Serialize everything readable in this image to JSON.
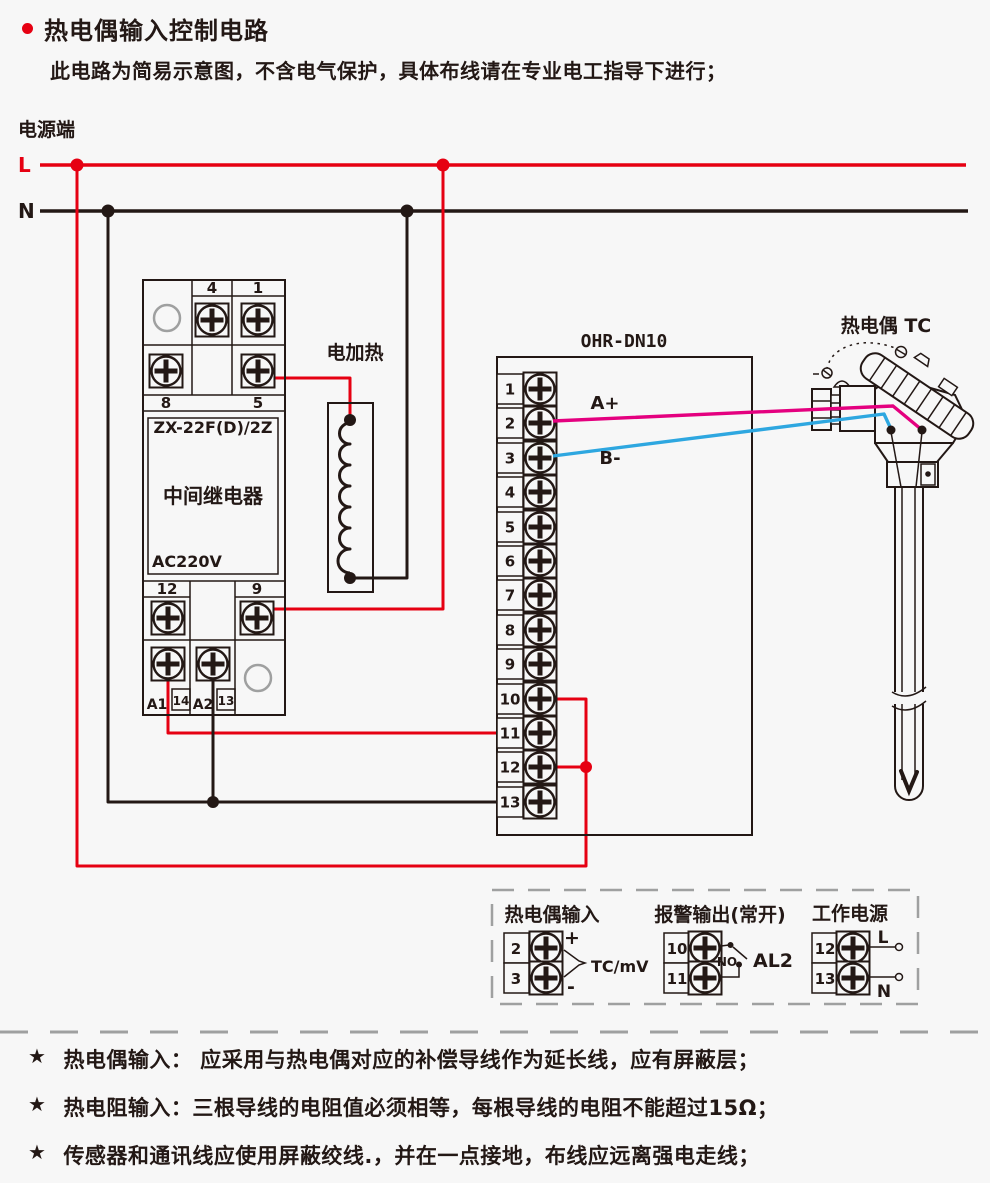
{
  "header": {
    "title": "热电偶输入控制电路",
    "subtitle": "此电路为简易示意图，不含电气保护，具体布线请在专业电工指导下进行；"
  },
  "power": {
    "label": "电源端",
    "l": "L",
    "n": "N"
  },
  "relay": {
    "model": "ZX-22F(D)/2Z",
    "name": "中间继电器",
    "voltage": "AC220V",
    "pins": {
      "p4": "4",
      "p1": "1",
      "p8": "8",
      "p5": "5",
      "p12": "12",
      "p9": "9",
      "pa1": "A1",
      "p14": "14",
      "pa2": "A2",
      "p13": "13"
    }
  },
  "heater": {
    "label": "电加热"
  },
  "controller": {
    "title": "OHR-DN10",
    "terminals": [
      "1",
      "2",
      "3",
      "4",
      "5",
      "6",
      "7",
      "8",
      "9",
      "10",
      "11",
      "12",
      "13"
    ],
    "wire_a": "A+",
    "wire_b": "B-"
  },
  "thermocouple": {
    "label": "热电偶 TC"
  },
  "legend": {
    "groups": [
      {
        "title": "热电偶输入",
        "top": "2",
        "bottom": "3",
        "plus": "+",
        "minus": "-",
        "caption": "TC/mV"
      },
      {
        "title": "报警输出(常开)",
        "top": "10",
        "bottom": "11",
        "no": "NO",
        "caption": "AL2"
      },
      {
        "title": "工作电源",
        "top": "12",
        "bottom": "13",
        "l": "L",
        "n": "N"
      }
    ]
  },
  "notes": [
    {
      "bullet": "★",
      "text": "热电偶输入： 应采用与热电偶对应的补偿导线作为延长线，应有屏蔽层；"
    },
    {
      "bullet": "★",
      "text": "热电阻输入：三根导线的电阻值必须相等，每根导线的电阻不能超过15Ω；"
    },
    {
      "bullet": "★",
      "text": "传感器和通讯线应使用屏蔽绞线.，并在一点接地，布线应远离强电走线；"
    }
  ],
  "colors": {
    "background": "#f7f7f7",
    "line": "#231815",
    "red": "#e60012",
    "magenta": "#e4007f",
    "blue": "#2ea7e0",
    "gray": "#9fa0a0"
  }
}
